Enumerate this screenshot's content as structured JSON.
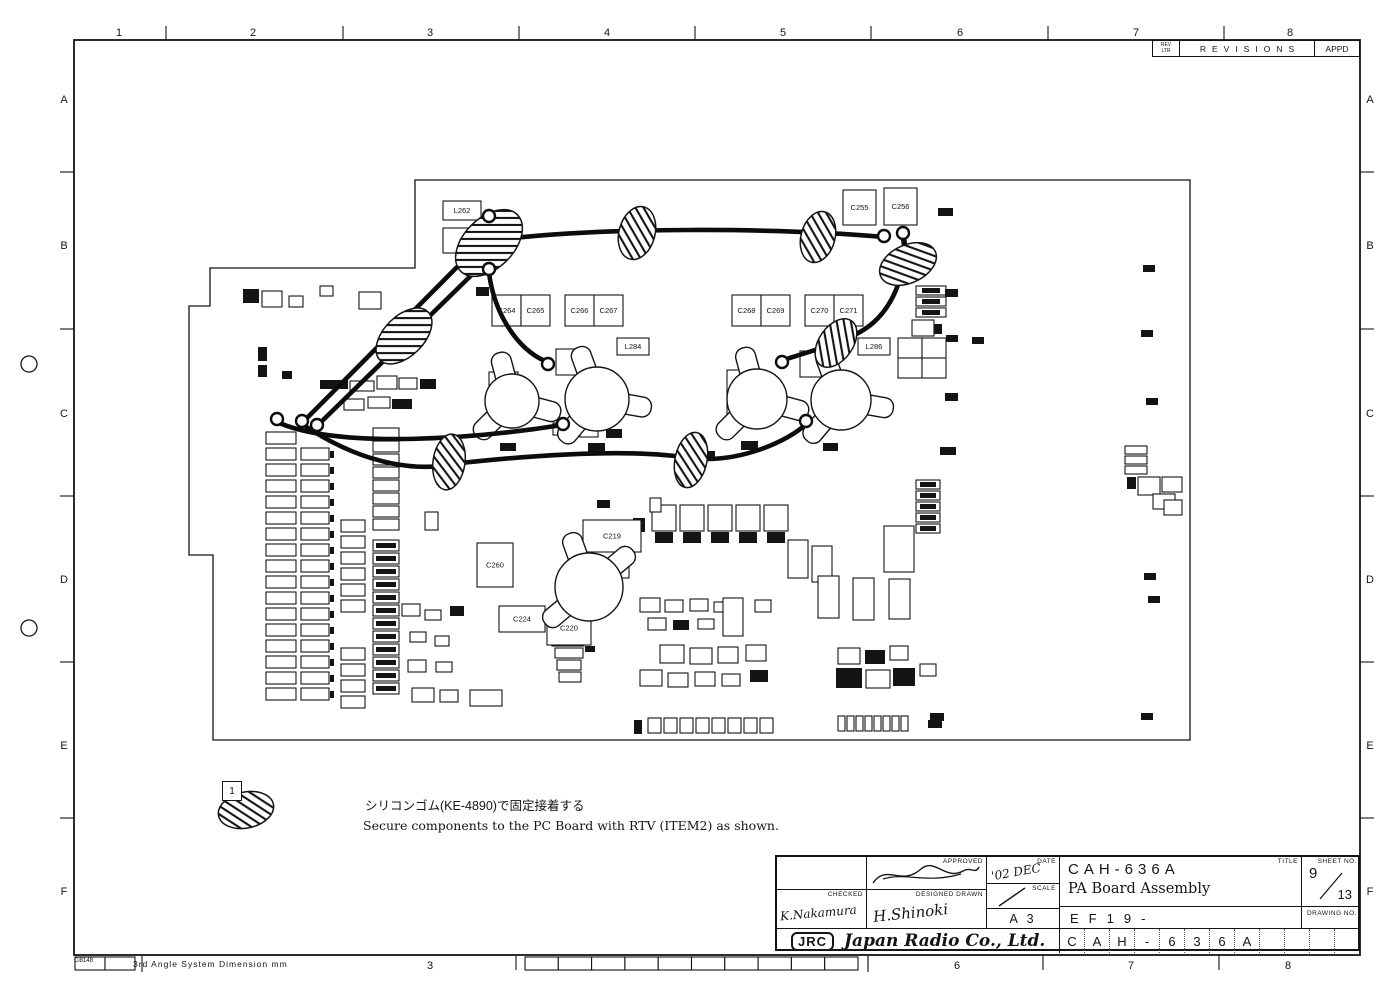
{
  "sheet": {
    "border": {
      "columns": [
        "1",
        "2",
        "3",
        "4",
        "5",
        "6",
        "7",
        "8"
      ],
      "rows": [
        "A",
        "B",
        "C",
        "D",
        "E",
        "F"
      ]
    },
    "revisions": {
      "rev_ltr_line1": "REV",
      "rev_ltr_line2": "LTR",
      "title": "REVISIONS",
      "appd": "APPD"
    },
    "note": {
      "item_no": "1",
      "text_jp": "シリコンゴム(KE-4890)で固定接着する",
      "text_en": "Secure components to the PC Board with RTV (ITEM2) as shown."
    },
    "footer": {
      "form_code": "Ci8148",
      "projection_note": "3rd Angle System  Dimension mm"
    },
    "title_block": {
      "labels": {
        "approved": "APPROVED",
        "checked": "CHECKED",
        "designed_drawn": "DESIGNED DRAWN",
        "date": "DATE",
        "scale": "SCALE",
        "title": "TITLE",
        "sheet_no": "SHEET NO.",
        "drawing_no": "DRAWING NO."
      },
      "model": "CAH-636A",
      "product": "PA Board Assembly",
      "sheet_num": "9",
      "sheet_total": "13",
      "paper_size": "A 3",
      "code_prefix": "EF19-",
      "drawing_number": "CAH-636A",
      "date_value": "'02 DEC",
      "signatures": {
        "checked": "K.Nakamura",
        "designed_drawn": "H.Shinoki"
      },
      "company": {
        "logo": "JRC",
        "name": "Japan Radio Co., Ltd."
      }
    },
    "board": {
      "components": [
        {
          "label": "L262",
          "x": 443,
          "y": 201,
          "w": 38,
          "h": 19
        },
        {
          "label": "C263",
          "x": 443,
          "y": 228,
          "w": 50,
          "h": 25
        },
        {
          "label": "C255",
          "x": 843,
          "y": 190,
          "w": 33,
          "h": 35
        },
        {
          "label": "C256",
          "x": 884,
          "y": 188,
          "w": 33,
          "h": 37
        },
        {
          "label": "C264",
          "x": 492,
          "y": 295,
          "w": 29,
          "h": 31
        },
        {
          "label": "C265",
          "x": 521,
          "y": 295,
          "w": 29,
          "h": 31
        },
        {
          "label": "C266",
          "x": 565,
          "y": 295,
          "w": 29,
          "h": 31
        },
        {
          "label": "C267",
          "x": 594,
          "y": 295,
          "w": 29,
          "h": 31
        },
        {
          "label": "C268",
          "x": 732,
          "y": 295,
          "w": 29,
          "h": 31
        },
        {
          "label": "C269",
          "x": 761,
          "y": 295,
          "w": 29,
          "h": 31
        },
        {
          "label": "C270",
          "x": 805,
          "y": 295,
          "w": 29,
          "h": 31
        },
        {
          "label": "C271",
          "x": 834,
          "y": 295,
          "w": 29,
          "h": 31
        },
        {
          "label": "L284",
          "x": 617,
          "y": 338,
          "w": 32,
          "h": 17
        },
        {
          "label": "L286",
          "x": 858,
          "y": 338,
          "w": 32,
          "h": 17
        },
        {
          "label": "C284",
          "x": 489,
          "y": 372,
          "w": 29,
          "h": 54
        },
        {
          "label": "C287",
          "x": 727,
          "y": 370,
          "w": 29,
          "h": 54
        },
        {
          "label": "C219",
          "x": 583,
          "y": 520,
          "w": 58,
          "h": 32
        },
        {
          "label": "C260",
          "x": 477,
          "y": 543,
          "w": 36,
          "h": 44
        },
        {
          "label": "C224",
          "x": 499,
          "y": 606,
          "w": 46,
          "h": 26
        },
        {
          "label": "C220",
          "x": 547,
          "y": 611,
          "w": 44,
          "h": 34
        }
      ]
    }
  }
}
